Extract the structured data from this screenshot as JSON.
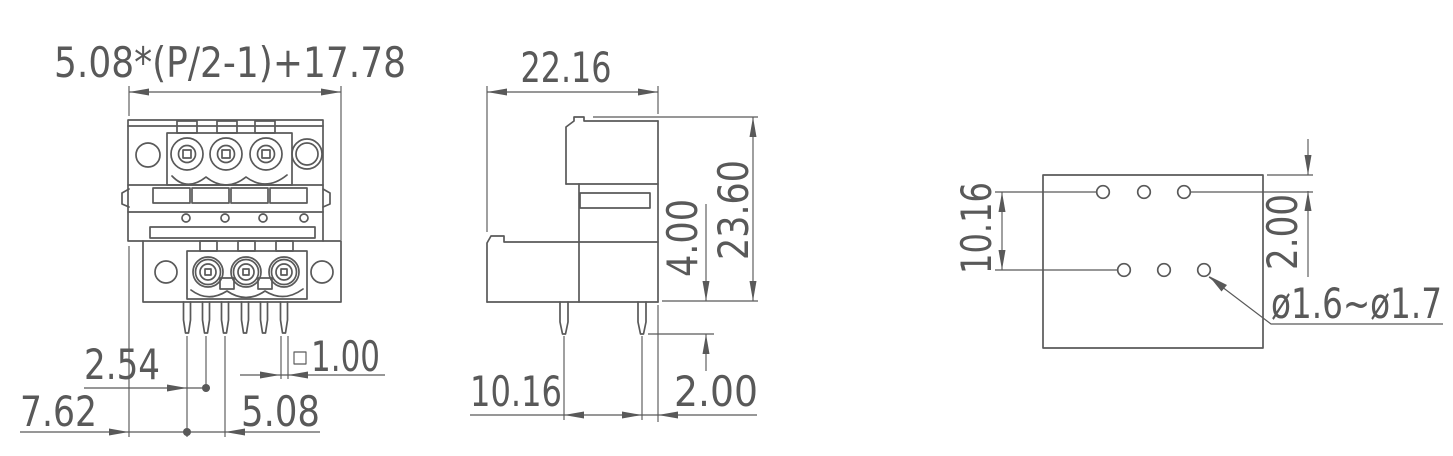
{
  "drawing": {
    "front_view": {
      "overall_width_formula": "5.08*(P/2-1)+17.78",
      "row_offset": "2.54",
      "edge_to_first_pin": "7.62",
      "pin_pitch": "5.08",
      "pin_cross_section": "1.00",
      "pin_cross_section_symbol": "□"
    },
    "side_view": {
      "depth": "22.16",
      "total_height": "23.60",
      "pin_length": "4.00",
      "pin_row_spacing": "10.16",
      "pin_edge_offset": "2.00"
    },
    "pcb_layout": {
      "row_spacing": "10.16",
      "edge_to_hole": "2.00",
      "hole_diameter_range": "ø1.6~ø1.7"
    },
    "style": {
      "line_color": "#595959",
      "background": "#ffffff"
    }
  }
}
